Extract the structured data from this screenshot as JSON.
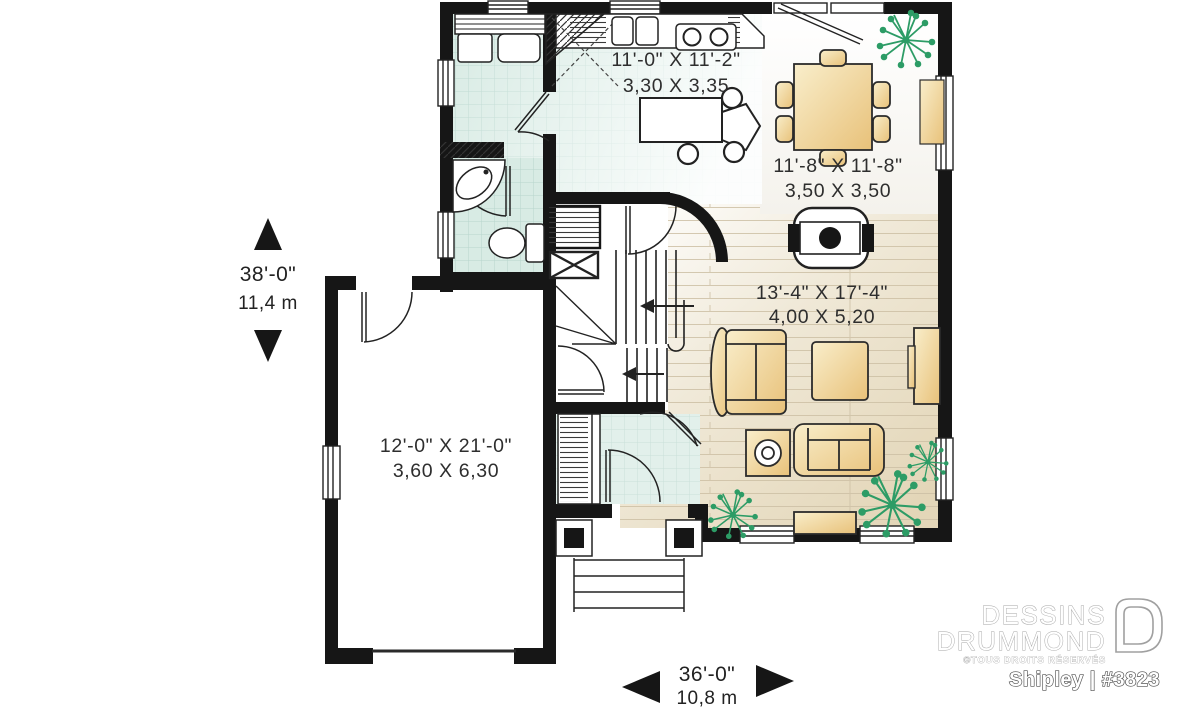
{
  "plan": {
    "rooms": [
      {
        "id": "kitchen",
        "imperial": "11'-0\" X 11'-2\"",
        "metric": "3,30 X 3,35"
      },
      {
        "id": "dining",
        "imperial": "11'-8\" X 11'-8\"",
        "metric": "3,50 X 3,50"
      },
      {
        "id": "living",
        "imperial": "13'-4\" X 17'-4\"",
        "metric": "4,00 X 5,20"
      },
      {
        "id": "garage",
        "imperial": "12'-0\" X 21'-0\"",
        "metric": "3,60 X 6,30"
      }
    ],
    "overall_depth": {
      "imperial": "38'-0\"",
      "metric": "11,4 m"
    },
    "overall_width": {
      "imperial": "36'-0\"",
      "metric": "10,8 m"
    }
  },
  "branding": {
    "brand_line1": "DESSINS",
    "brand_line2": "DRUMMOND",
    "rights": "©TOUS DROITS RÉSERVÉS",
    "plan_id": "Shipley | #3823"
  },
  "colors": {
    "wall": "#161616",
    "tile": "#d8ebe4",
    "tile_line": "#b7d6cd",
    "wood_floor": "#e5dabf",
    "furniture": "#eecd8a",
    "plant": "#2d9c66"
  }
}
